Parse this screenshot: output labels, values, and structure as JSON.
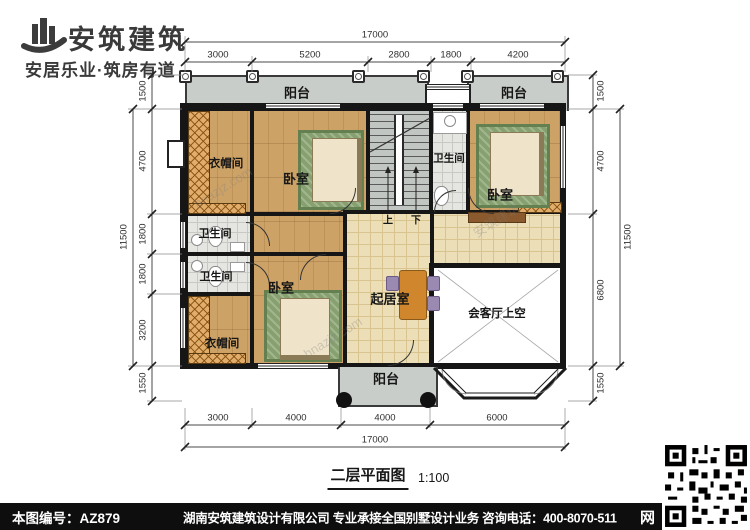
{
  "logo": {
    "name": "安筑建筑",
    "tagline": "安居乐业·筑房有道"
  },
  "plan": {
    "title": "二层平面图",
    "scale": "1:100",
    "rooms": {
      "balcony_top_left": "阳台",
      "balcony_top_right": "阳台",
      "balcony_bottom": "阳台",
      "cloak_top": "衣帽间",
      "cloak_bottom": "衣帽间",
      "bedroom_top": "卧室",
      "bedroom_right": "卧室",
      "bedroom_mid": "卧室",
      "bath_top_right": "卫生间",
      "bath_mid_upper": "卫生间",
      "bath_mid_lower": "卫生间",
      "living": "起居室",
      "void_above_hall": "会客厅上空",
      "stair_up": "上",
      "stair_down": "下"
    },
    "dims": {
      "top_total": "17000",
      "top_segments": [
        "3000",
        "5200",
        "2800",
        "1800",
        "4200"
      ],
      "bottom_segments": [
        "3000",
        "4000",
        "4000",
        "6000"
      ],
      "bottom_total": "17000",
      "left_total": "11500",
      "left_segments": [
        "1500",
        "4700",
        "1800",
        "1800",
        "3200",
        "1550"
      ],
      "right_total": "11500",
      "right_segments": [
        "1500",
        "4700",
        "6800",
        "1550"
      ]
    },
    "watermarks": [
      "hnazjz.com",
      "安筑建筑",
      "hnazjz.com"
    ]
  },
  "footer": {
    "plan_number": "本图编号：AZ879",
    "company_info": "湖南安筑建筑设计有限公司  专业承接全国别墅设计业务  咨询电话：400-8070-511",
    "web_char": "网"
  },
  "colors": {
    "wall": "#161616",
    "wood_floor": "#cda266",
    "bath_tile": "#e5e5e1",
    "living_tile": "#ecdfb8",
    "balcony": "#c9cdc9",
    "wardrobe_hatch": "#e0ae6a",
    "rug_green": "#87a070",
    "footer_bg": "#0e0e0e"
  }
}
